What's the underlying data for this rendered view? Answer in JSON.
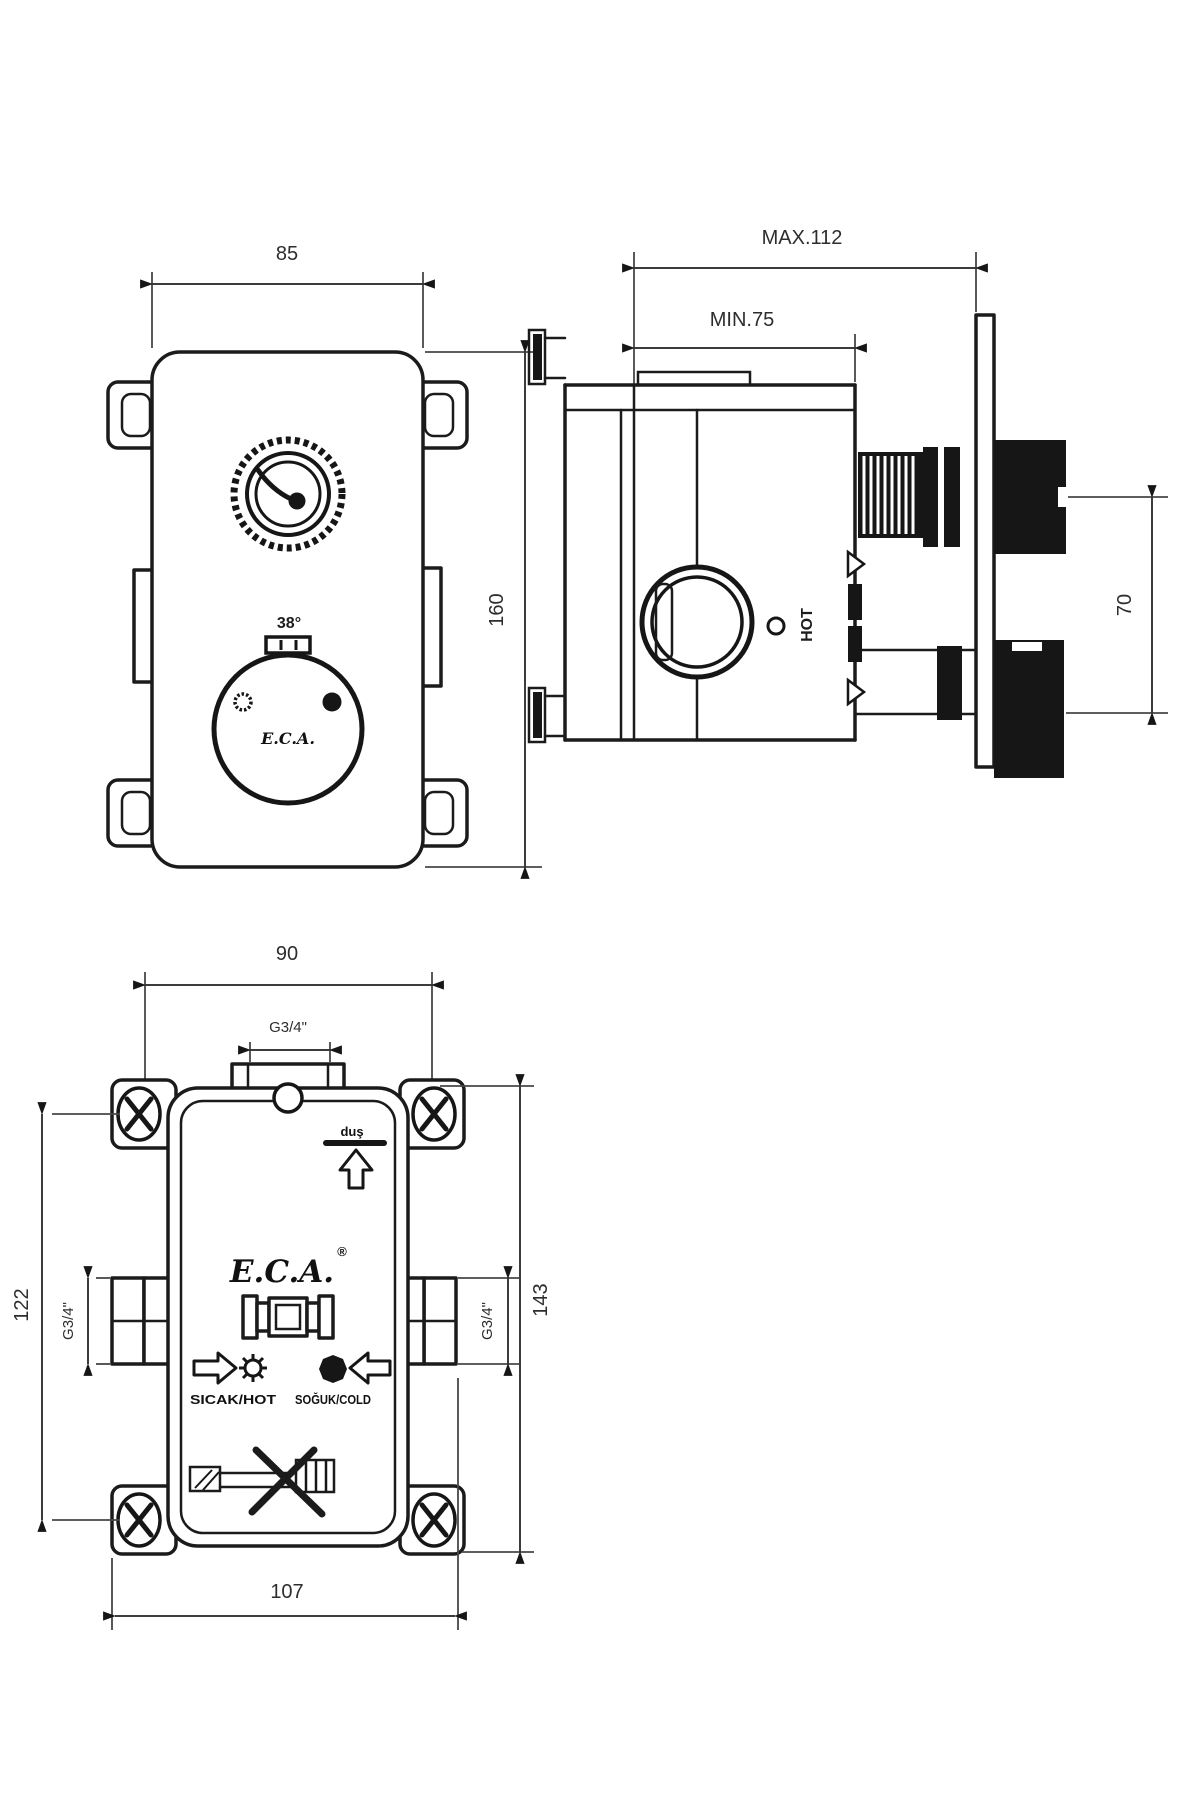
{
  "front": {
    "dim_width": "85",
    "dim_height": "160",
    "temp_mark": "38°",
    "knob_logo": "E.C.A."
  },
  "side": {
    "dim_max": "MAX.112",
    "dim_min": "MIN.75",
    "dim_knob_spacing": "70",
    "hot_label": "HOT"
  },
  "back": {
    "dim_screw_span": "90",
    "dim_top_port": "G3/4\"",
    "dim_left_port": "G3/4\"",
    "dim_right_port": "G3/4\"",
    "dim_screw_height": "122",
    "dim_body_height": "143",
    "dim_bottom_span": "107",
    "logo": "E.C.A.",
    "logo_reg": "®",
    "shower_label": "duş",
    "hot_inlet_label": "SICAK/HOT",
    "cold_inlet_label": "SOĞUK/COLD"
  }
}
